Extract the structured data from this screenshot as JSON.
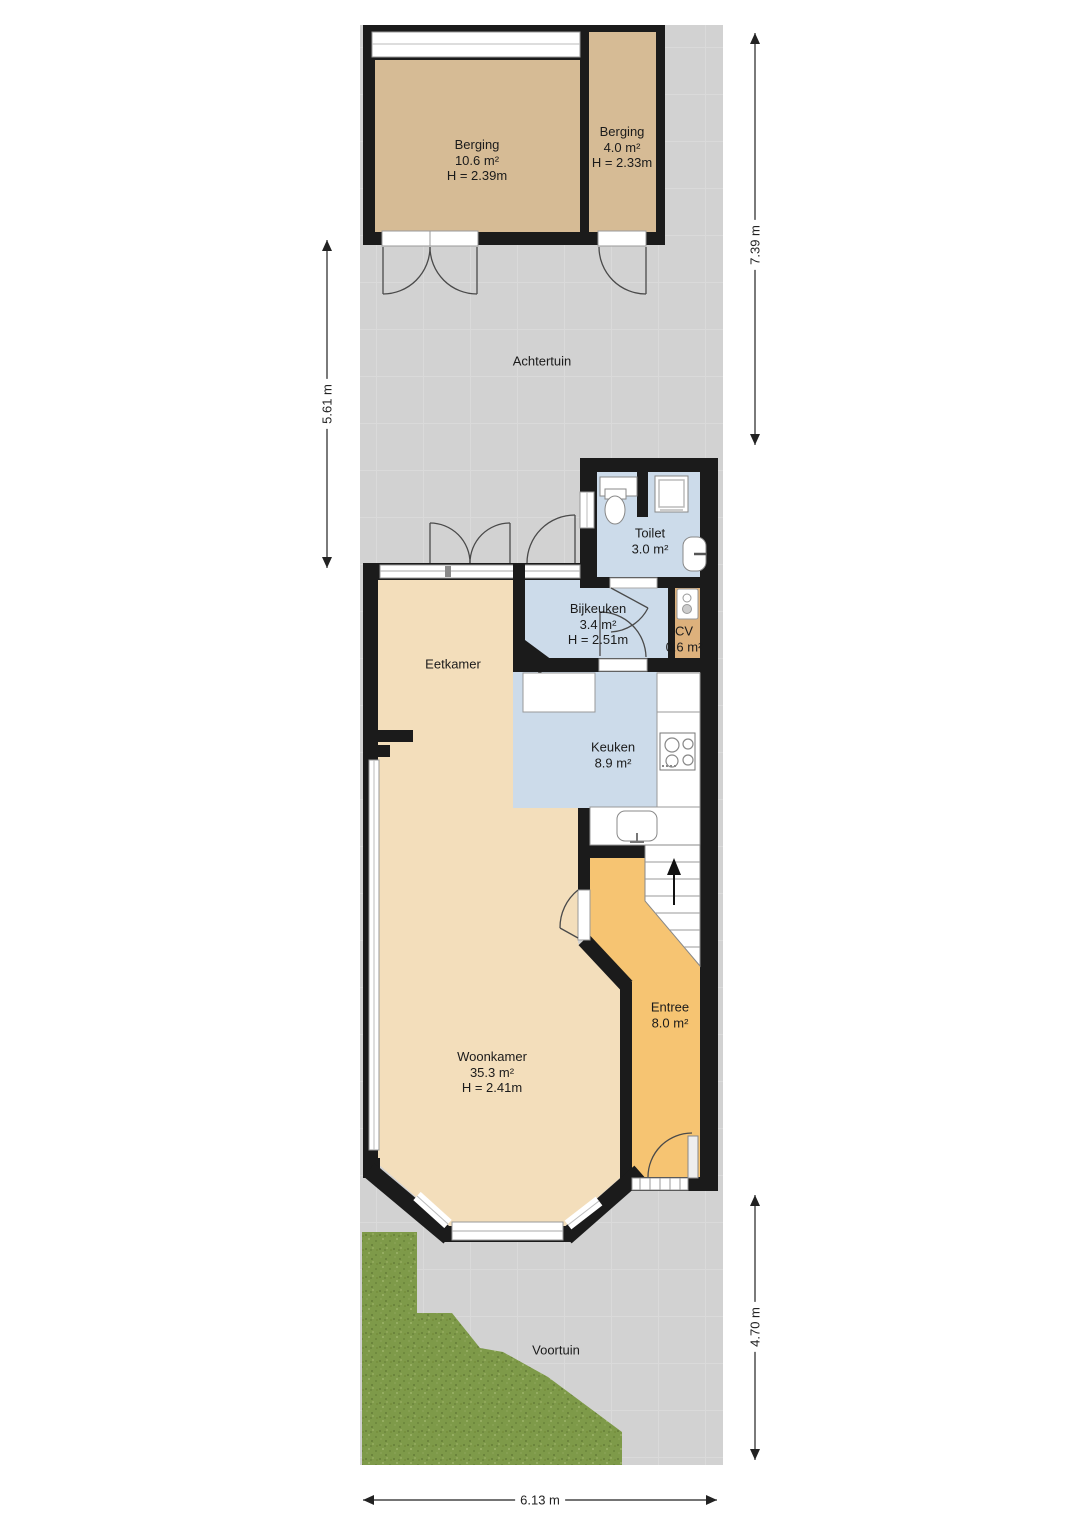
{
  "plan": {
    "rooms": {
      "berging_left": {
        "name": "Berging",
        "area": "10.6 m²",
        "height": "H = 2.39m"
      },
      "berging_right": {
        "name": "Berging",
        "area": "4.0 m²",
        "height": "H = 2.33m"
      },
      "achtertuin": {
        "name": "Achtertuin"
      },
      "toilet": {
        "name": "Toilet",
        "area": "3.0 m²"
      },
      "bijkeuken": {
        "name": "Bijkeuken",
        "area": "3.4 m²",
        "height": "H = 2.51m"
      },
      "cv": {
        "name": "CV",
        "area": "0.6 m²"
      },
      "eetkamer": {
        "name": "Eetkamer"
      },
      "keuken": {
        "name": "Keuken",
        "area": "8.9 m²"
      },
      "woonkamer": {
        "name": "Woonkamer",
        "area": "35.3 m²",
        "height": "H = 2.41m"
      },
      "entree": {
        "name": "Entree",
        "area": "8.0 m²"
      },
      "voortuin": {
        "name": "Voortuin"
      }
    },
    "dimensions": {
      "garden_depth_right": "7.39 m",
      "garden_depth_left": "5.61 m",
      "front_depth_right": "4.70 m",
      "lot_width_bottom": "6.13 m"
    },
    "colors": {
      "wall": "#1b1b1b",
      "paving": "#d2d2d2",
      "storage_floor": "#d6bb95",
      "living_floor": "#f3debb",
      "entry_floor": "#f6c472",
      "wet_room_floor": "#ccdbea",
      "cv_floor": "#ddb17c",
      "grass": "#7e9a49"
    }
  }
}
